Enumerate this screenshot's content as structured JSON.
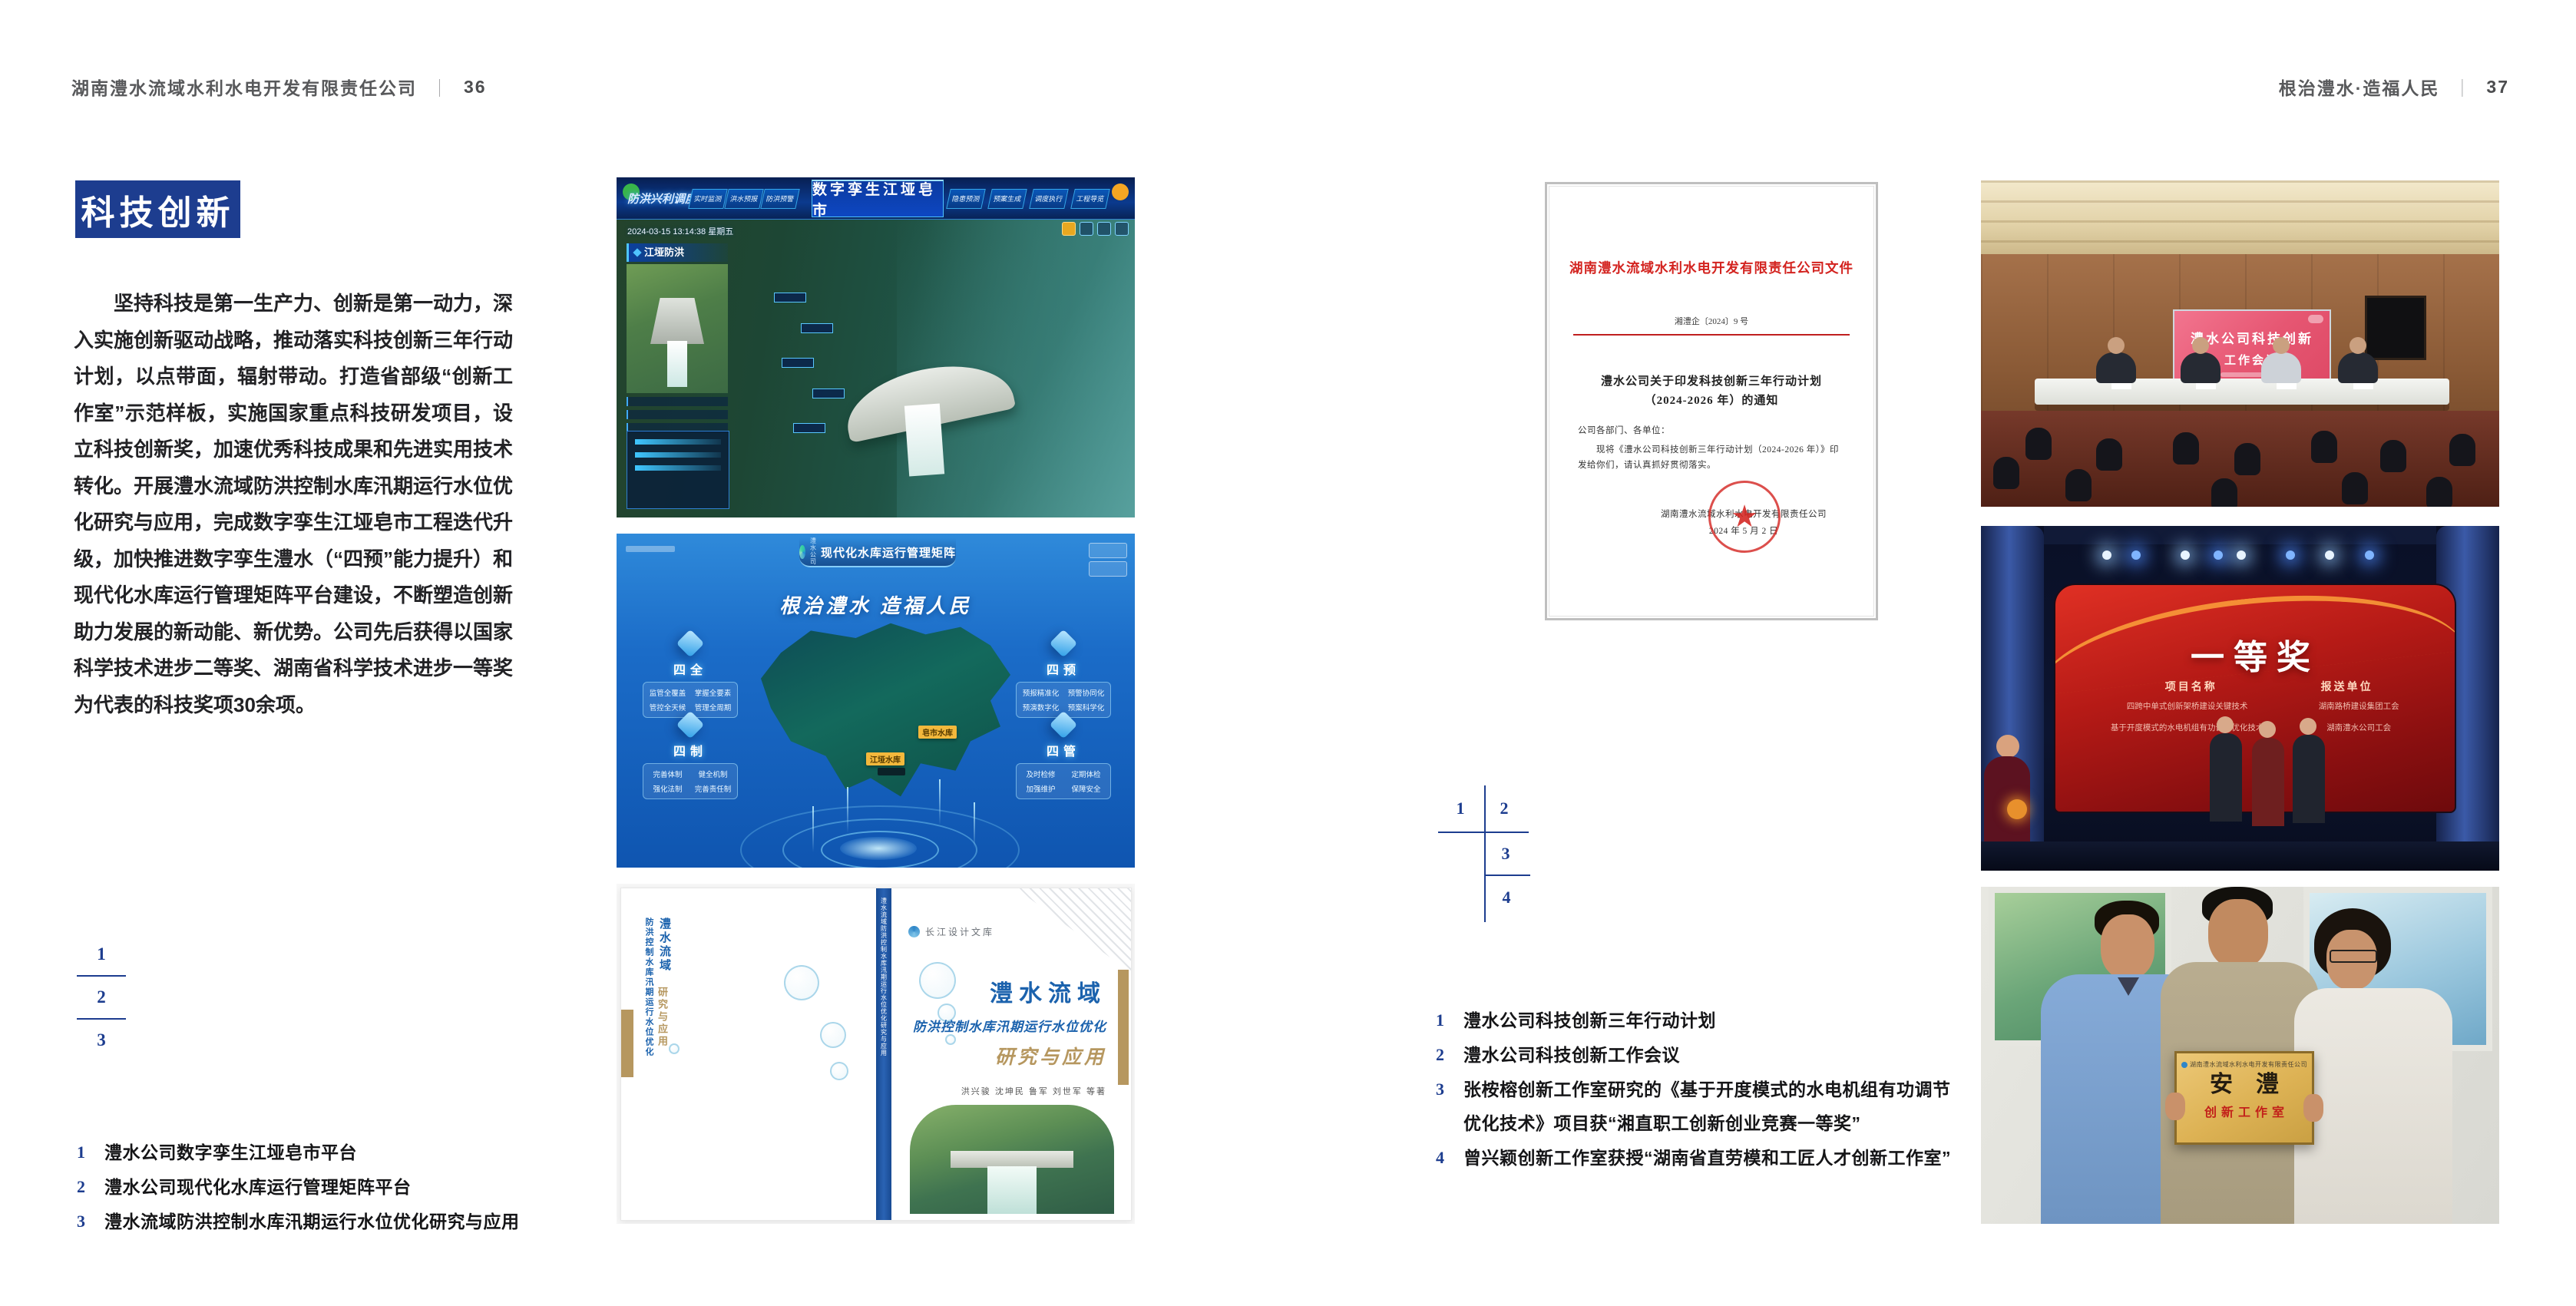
{
  "colors": {
    "accent_navy": "#1d3d8f",
    "document_red": "#d3231f",
    "book_blue": "#1b62ad",
    "book_tan": "#b6975f"
  },
  "left_page": {
    "header": {
      "company": "湖南澧水流域水利水电开发有限责任公司",
      "divider": "｜",
      "page_num": "36"
    },
    "badge": "科技创新",
    "paragraph": "坚持科技是第一生产力、创新是第一动力，深入实施创新驱动战略，推动落实科技创新三年行动计划，以点带面，辐射带动。打造省部级“创新工作室”示范样板，实施国家重点科技研发项目，设立科技创新奖，加速优秀科技成果和先进实用技术转化。开展澧水流域防洪控制水库汛期运行水位优化研究与应用，完成数字孪生江垭皂市工程迭代升级，加快推进数字孪生澧水（“四预”能力提升）和现代化水库运行管理矩阵平台建设，不断塑造创新助力发展的新动能、新优势。公司先后获得以国家科学技术进步二等奖、湖南省科学技术进步一等奖为代表的科技奖项30余项。",
    "figure_index": [
      "1",
      "2",
      "3"
    ],
    "captions": [
      {
        "num": "1",
        "text": "澧水公司数字孪生江垭皂市平台"
      },
      {
        "num": "2",
        "text": "澧水公司现代化水库运行管理矩阵平台"
      },
      {
        "num": "3",
        "text": "澧水流域防洪控制水库汛期运行水位优化研究与应用"
      }
    ],
    "fig_dashboard": {
      "highlight_label": "防洪兴利调度",
      "tabs_left": [
        "实时监测",
        "洪水预报",
        "防洪预警"
      ],
      "title": "数字孪生江垭皂市",
      "tabs_right": [
        "隐患预测",
        "预案生成",
        "调度执行",
        "工程导览"
      ],
      "timestamp": "2024-03-15 13:14:38 星期五",
      "panel_title": "江垭防洪"
    },
    "fig_matrix": {
      "logo_name": "澧水公司",
      "title": "现代化水库运行管理矩阵",
      "slogan": "根治澧水 造福人民",
      "panels": [
        {
          "name": "四全",
          "items": [
            "监管全覆盖",
            "掌握全要素",
            "管控全天候",
            "管理全周期"
          ]
        },
        {
          "name": "四预",
          "items": [
            "预报精准化",
            "预警协同化",
            "预演数字化",
            "预案科学化"
          ]
        },
        {
          "name": "四制",
          "items": [
            "完善体制",
            "健全机制",
            "强化法制",
            "完善责任制"
          ]
        },
        {
          "name": "四管",
          "items": [
            "及时检修",
            "定期体检",
            "加强维护",
            "保障安全"
          ]
        }
      ],
      "map_labels": [
        "皂市水库",
        "江垭水库"
      ]
    },
    "fig_book": {
      "series": "长江设计文库",
      "title_main": "澧水流域",
      "title_sub": "防洪控制水库汛期运行水位优化",
      "title_accent": "研究与应用",
      "authors": "洪兴骏 沈坤民 鲁军 刘世军 等著",
      "spine": "澧水流域防洪控制水库汛期运行水位优化研究与应用",
      "back_main": "澧水流域",
      "back_sub": "防洪控制水库汛期运行水位优化",
      "back_accent": "研究与应用"
    }
  },
  "right_page": {
    "header": {
      "motto": "根治澧水·造福人民",
      "divider": "｜",
      "page_num": "37"
    },
    "figure_index": [
      "1",
      "2",
      "3",
      "4"
    ],
    "captions": [
      {
        "num": "1",
        "text": "澧水公司科技创新三年行动计划"
      },
      {
        "num": "2",
        "text": "澧水公司科技创新工作会议"
      },
      {
        "num": "3",
        "text": "张桉榕创新工作室研究的《基于开度模式的水电机组有功调节",
        "text2": "优化技术》项目获“湘直职工创新创业竞赛一等奖”"
      },
      {
        "num": "4",
        "text": "曾兴颖创新工作室获授“湖南省直劳模和工匠人才创新工作室”"
      }
    ],
    "fig_document": {
      "org_title": "湖南澧水流域水利水电开发有限责任公司文件",
      "doc_no": "湘澧企〔2024〕9 号",
      "subject1": "澧水公司关于印发科技创新三年行动计划",
      "subject2": "（2024-2026 年）的通知",
      "salutation": "公司各部门、各单位：",
      "body1": "现将《澧水公司科技创新三年行动计划（2024-2026 年）》印",
      "body2": "发给你们，请认真抓好贯彻落实。",
      "signature": "湖南澧水流域水利水电开发有限责任公司",
      "date": "2024 年 5 月 2 日",
      "seal_star": "★"
    },
    "fig_meeting": {
      "screen_line1": "澧水公司科技创新",
      "screen_line2": "工作会议"
    },
    "fig_award": {
      "title": "一等奖",
      "col1": "项目名称",
      "col2": "报送单位",
      "row1_project": "四跨中单式创新架桥建设关键技术",
      "row1_unit": "湖南路桥建设集团工会",
      "row2_project": "基于开度模式的水电机组有功调节优化技术",
      "row2_unit": "湖南澧水公司工会"
    },
    "fig_plaque": {
      "org": "湖南澧水流域水利水电开发有限责任公司",
      "name": "安澧",
      "subtitle": "创新工作室"
    }
  }
}
